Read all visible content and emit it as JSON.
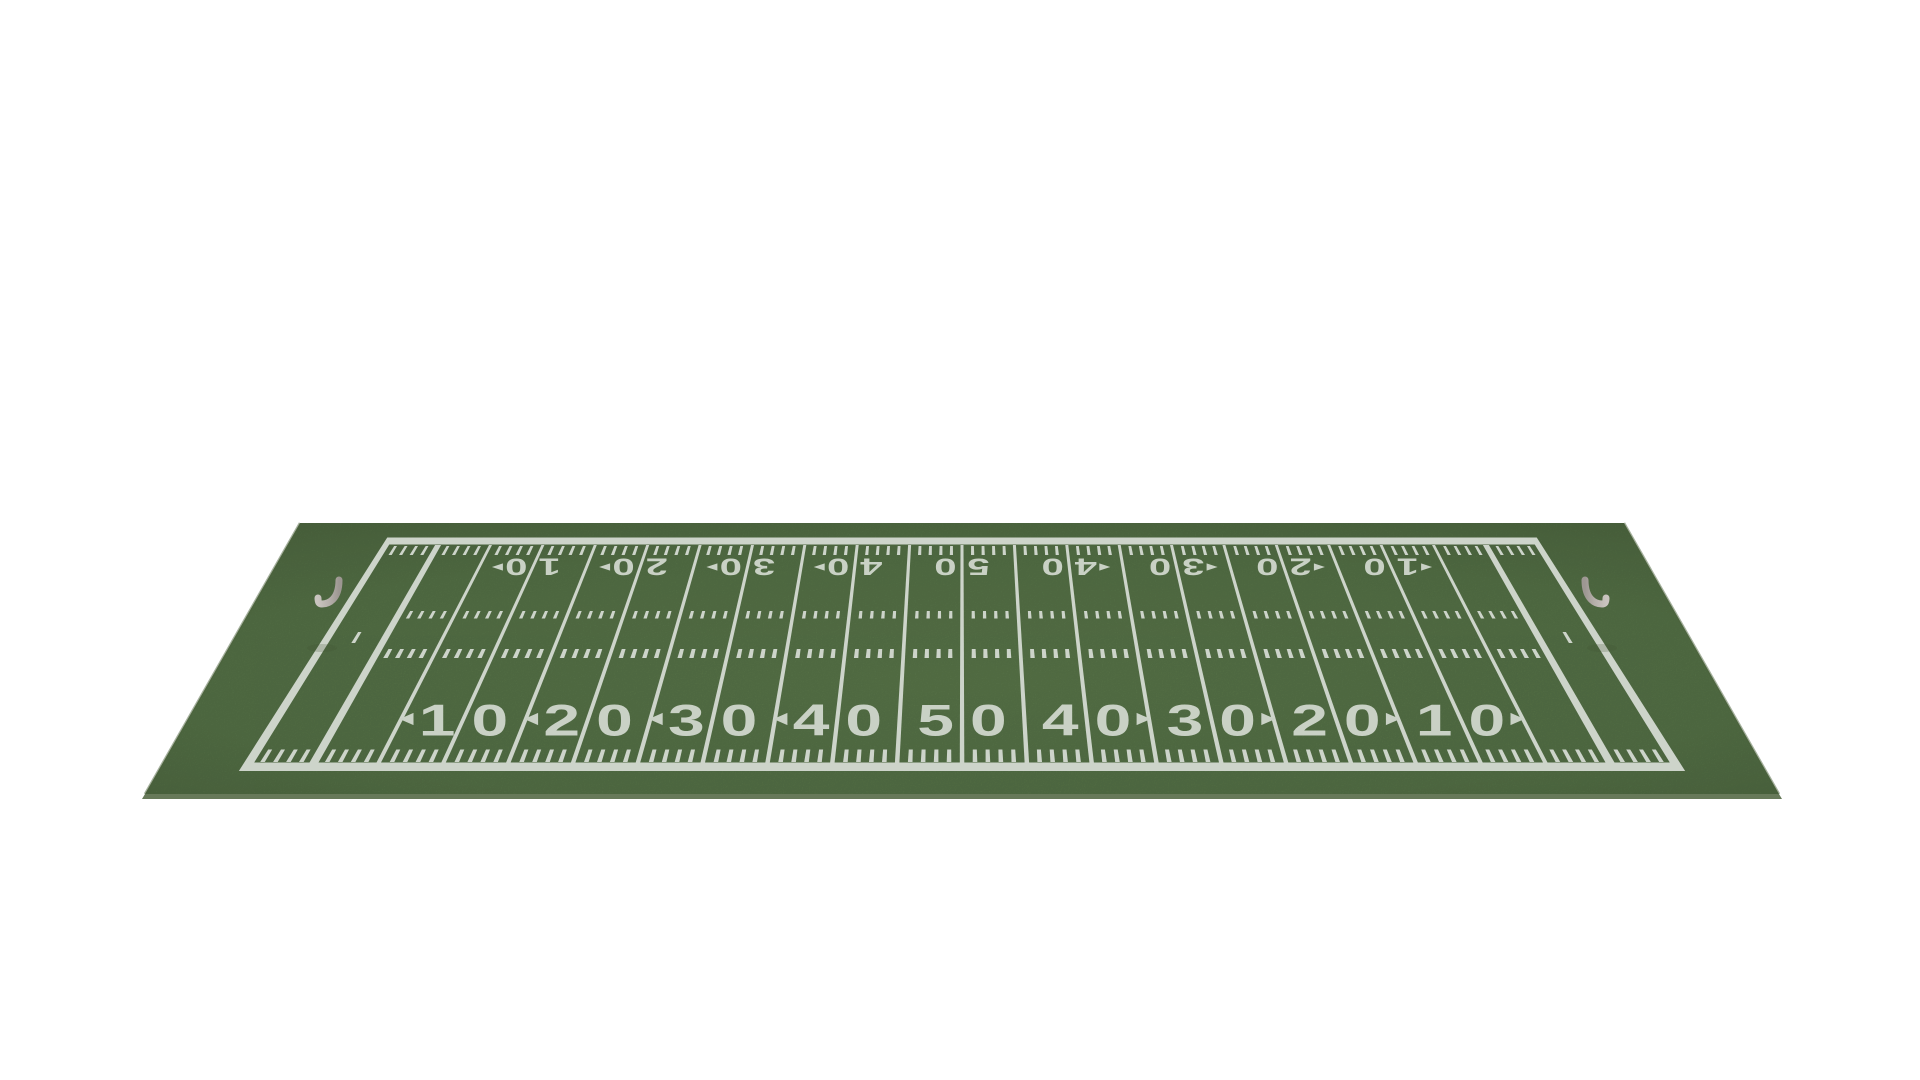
{
  "scene": {
    "description": "3D rendered American football field viewed from a low angle on a plain white background",
    "background_color": "#ffffff"
  },
  "field": {
    "yard_labels_near_sideline": [
      "10",
      "20",
      "30",
      "40",
      "50",
      "40",
      "30",
      "20",
      "10"
    ],
    "yard_labels_far_sideline": [
      "10",
      "20",
      "30",
      "40",
      "50",
      "40",
      "30",
      "20",
      "10"
    ],
    "numbers_near": [
      {
        "d1": "1",
        "d2": "0",
        "arrow": "left"
      },
      {
        "d1": "2",
        "d2": "0",
        "arrow": "left"
      },
      {
        "d1": "3",
        "d2": "0",
        "arrow": "left"
      },
      {
        "d1": "4",
        "d2": "0",
        "arrow": "left"
      },
      {
        "d1": "5",
        "d2": "0",
        "arrow": "none"
      },
      {
        "d1": "4",
        "d2": "0",
        "arrow": "right"
      },
      {
        "d1": "3",
        "d2": "0",
        "arrow": "right"
      },
      {
        "d1": "2",
        "d2": "0",
        "arrow": "right"
      },
      {
        "d1": "1",
        "d2": "0",
        "arrow": "right"
      }
    ],
    "numbers_far": [
      {
        "d1": "1",
        "d2": "0",
        "arrow": "right"
      },
      {
        "d1": "2",
        "d2": "0",
        "arrow": "right"
      },
      {
        "d1": "3",
        "d2": "0",
        "arrow": "right"
      },
      {
        "d1": "4",
        "d2": "0",
        "arrow": "right"
      },
      {
        "d1": "5",
        "d2": "0",
        "arrow": "none"
      },
      {
        "d1": "4",
        "d2": "0",
        "arrow": "left"
      },
      {
        "d1": "3",
        "d2": "0",
        "arrow": "left"
      },
      {
        "d1": "2",
        "d2": "0",
        "arrow": "left"
      },
      {
        "d1": "1",
        "d2": "0",
        "arrow": "left"
      }
    ],
    "markings": {
      "border": "white boundary rectangle around field and end zones",
      "yard_lines_every": 5,
      "hash_rows": 2,
      "sideline_tick_rows": 2,
      "conversion_dash_near_each_goal": true,
      "end_zones_empty": true
    }
  },
  "goalposts": {
    "count": 2,
    "style": "gray gooseneck post with two uprights",
    "positions": [
      "left end line",
      "right end line"
    ]
  },
  "colors": {
    "turf_green": "#5a774a",
    "turf_green_light": "#5e7c4d",
    "turf_green_edge": "#4f6941",
    "turf_edge_dark": "#4c613c",
    "line_white": "#cdd4ca",
    "number_white": "#c9d1c5",
    "goalpost_gray": "#b5afaa",
    "goalpost_gray_light": "#c9c4bf",
    "background_white": "#ffffff"
  }
}
